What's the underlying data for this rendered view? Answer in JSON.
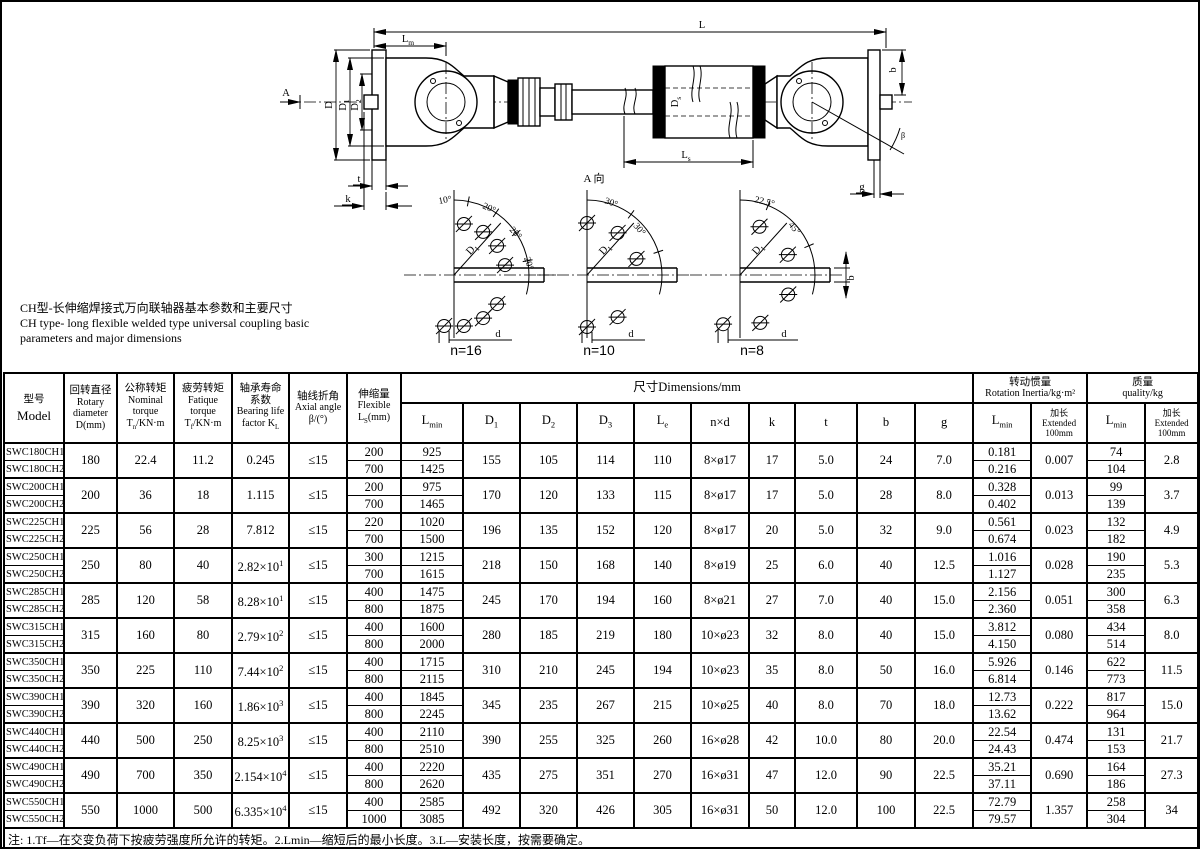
{
  "title_block": {
    "zh": "CH型-长伸缩焊接式万向联轴器基本参数和主要尺寸",
    "en1": "CH type- long flexible welded type universal coupling basic",
    "en2": "parameters and major dimensions"
  },
  "drawing": {
    "lbl": {
      "L": "L",
      "Lm_b": "L",
      "Lm_s": "m",
      "Ls_b": "L",
      "Ls_s": "s",
      "D": "D",
      "D1_b": "D",
      "D1_s": "1",
      "D2_b": "D",
      "D2_s": "2",
      "Ds_b": "D",
      "Ds_s": "s",
      "A": "A",
      "view_label": "A 向",
      "t": "t",
      "k": "k",
      "g": "g",
      "b": "b",
      "beta": "β"
    },
    "diagrams": [
      {
        "label": "n=16",
        "angles": [
          "10°",
          "20°",
          "20°",
          "20°"
        ],
        "radial_base": "D",
        "radial_sub": "1",
        "hole": "d"
      },
      {
        "label": "n=10",
        "angles": [
          "30°",
          "30°"
        ],
        "radial_base": "D",
        "radial_sub": "1",
        "hole": "d"
      },
      {
        "label": "n=8",
        "angles": [
          "22.5°",
          "45°"
        ],
        "radial_base": "D",
        "radial_sub": "1",
        "hole": "d",
        "width_label": "b"
      }
    ]
  },
  "table": {
    "h": {
      "model_zh": "型号",
      "model_en": "Model",
      "rotary": [
        "回转直径",
        "Rotary",
        "diameter",
        "D(mm)"
      ],
      "nominal": [
        "公称转矩",
        "Nominal",
        "torque"
      ],
      "tn": [
        "T",
        "n",
        "/KN·m"
      ],
      "fatigue": [
        "疲劳转矩",
        "Fatique",
        "torque"
      ],
      "tf": [
        "T",
        "f",
        "/KN·m"
      ],
      "bearing": [
        "轴承寿命",
        "系数",
        "Bearing life"
      ],
      "kl": [
        "factor  K",
        "L"
      ],
      "axial": [
        "轴线折角",
        "Axial angle",
        "β/(°)"
      ],
      "flex": [
        "伸缩量",
        "Flexible"
      ],
      "ls": [
        "L",
        "S",
        "(mm)"
      ],
      "dims": "尺寸Dimensions/mm",
      "lmin": [
        "L",
        "min"
      ],
      "d1": [
        "D",
        "1"
      ],
      "d2": [
        "D",
        "2"
      ],
      "d3": [
        "D",
        "3"
      ],
      "le": [
        "L",
        "e"
      ],
      "nxd": "n×d",
      "k": "k",
      "t": "t",
      "b": "b",
      "g": "g",
      "inertia_zh": "转动惯量",
      "inertia_en": "Rotation Inertia/kg·m²",
      "mass_zh": "质量",
      "mass_en": "quality/kg",
      "ext": [
        "加长",
        "Extended",
        "100mm"
      ]
    },
    "rows": [
      {
        "m": [
          "SWC180CH1",
          "SWC180CH2"
        ],
        "d": "180",
        "tn": "22.4",
        "tf": "11.2",
        "kl": "0.245",
        "beta": "≤15",
        "ls": [
          "200",
          "700"
        ],
        "lmin": [
          "925",
          "1425"
        ],
        "d1": "155",
        "d2": "105",
        "d3": "114",
        "le": "110",
        "nxd": "8×ø17",
        "k": "17",
        "t": "5.0",
        "b": "24",
        "g": "7.0",
        "ji": [
          "0.181",
          "0.216"
        ],
        "je": "0.007",
        "mi": [
          "74",
          "104"
        ],
        "me": "2.8"
      },
      {
        "m": [
          "SWC200CH1",
          "SWC200CH2"
        ],
        "d": "200",
        "tn": "36",
        "tf": "18",
        "kl": "1.115",
        "beta": "≤15",
        "ls": [
          "200",
          "700"
        ],
        "lmin": [
          "975",
          "1465"
        ],
        "d1": "170",
        "d2": "120",
        "d3": "133",
        "le": "115",
        "nxd": "8×ø17",
        "k": "17",
        "t": "5.0",
        "b": "28",
        "g": "8.0",
        "ji": [
          "0.328",
          "0.402"
        ],
        "je": "0.013",
        "mi": [
          "99",
          "139"
        ],
        "me": "3.7"
      },
      {
        "m": [
          "SWC225CH1",
          "SWC225CH2"
        ],
        "d": "225",
        "tn": "56",
        "tf": "28",
        "kl": "7.812",
        "beta": "≤15",
        "ls": [
          "220",
          "700"
        ],
        "lmin": [
          "1020",
          "1500"
        ],
        "d1": "196",
        "d2": "135",
        "d3": "152",
        "le": "120",
        "nxd": "8×ø17",
        "k": "20",
        "t": "5.0",
        "b": "32",
        "g": "9.0",
        "ji": [
          "0.561",
          "0.674"
        ],
        "je": "0.023",
        "mi": [
          "132",
          "182"
        ],
        "me": "4.9"
      },
      {
        "m": [
          "SWC250CH1",
          "SWC250CH2"
        ],
        "d": "250",
        "tn": "80",
        "tf": "40",
        "kl": "2.82×10^1",
        "beta": "≤15",
        "ls": [
          "300",
          "700"
        ],
        "lmin": [
          "1215",
          "1615"
        ],
        "d1": "218",
        "d2": "150",
        "d3": "168",
        "le": "140",
        "nxd": "8×ø19",
        "k": "25",
        "t": "6.0",
        "b": "40",
        "g": "12.5",
        "ji": [
          "1.016",
          "1.127"
        ],
        "je": "0.028",
        "mi": [
          "190",
          "235"
        ],
        "me": "5.3"
      },
      {
        "m": [
          "SWC285CH1",
          "SWC285CH2"
        ],
        "d": "285",
        "tn": "120",
        "tf": "58",
        "kl": "8.28×10^1",
        "beta": "≤15",
        "ls": [
          "400",
          "800"
        ],
        "lmin": [
          "1475",
          "1875"
        ],
        "d1": "245",
        "d2": "170",
        "d3": "194",
        "le": "160",
        "nxd": "8×ø21",
        "k": "27",
        "t": "7.0",
        "b": "40",
        "g": "15.0",
        "ji": [
          "2.156",
          "2.360"
        ],
        "je": "0.051",
        "mi": [
          "300",
          "358"
        ],
        "me": "6.3"
      },
      {
        "m": [
          "SWC315CH1",
          "SWC315CH2"
        ],
        "d": "315",
        "tn": "160",
        "tf": "80",
        "kl": "2.79×10^2",
        "beta": "≤15",
        "ls": [
          "400",
          "800"
        ],
        "lmin": [
          "1600",
          "2000"
        ],
        "d1": "280",
        "d2": "185",
        "d3": "219",
        "le": "180",
        "nxd": "10×ø23",
        "k": "32",
        "t": "8.0",
        "b": "40",
        "g": "15.0",
        "ji": [
          "3.812",
          "4.150"
        ],
        "je": "0.080",
        "mi": [
          "434",
          "514"
        ],
        "me": "8.0"
      },
      {
        "m": [
          "SWC350CH1",
          "SWC350CH2"
        ],
        "d": "350",
        "tn": "225",
        "tf": "110",
        "kl": "7.44×10^2",
        "beta": "≤15",
        "ls": [
          "400",
          "800"
        ],
        "lmin": [
          "1715",
          "2115"
        ],
        "d1": "310",
        "d2": "210",
        "d3": "245",
        "le": "194",
        "nxd": "10×ø23",
        "k": "35",
        "t": "8.0",
        "b": "50",
        "g": "16.0",
        "ji": [
          "5.926",
          "6.814"
        ],
        "je": "0.146",
        "mi": [
          "622",
          "773"
        ],
        "me": "11.5"
      },
      {
        "m": [
          "SWC390CH1",
          "SWC390CH2"
        ],
        "d": "390",
        "tn": "320",
        "tf": "160",
        "kl": "1.86×10^3",
        "beta": "≤15",
        "ls": [
          "400",
          "800"
        ],
        "lmin": [
          "1845",
          "2245"
        ],
        "d1": "345",
        "d2": "235",
        "d3": "267",
        "le": "215",
        "nxd": "10×ø25",
        "k": "40",
        "t": "8.0",
        "b": "70",
        "g": "18.0",
        "ji": [
          "12.73",
          "13.62"
        ],
        "je": "0.222",
        "mi": [
          "817",
          "964"
        ],
        "me": "15.0"
      },
      {
        "m": [
          "SWC440CH1",
          "SWC440CH2"
        ],
        "d": "440",
        "tn": "500",
        "tf": "250",
        "kl": "8.25×10^3",
        "beta": "≤15",
        "ls": [
          "400",
          "800"
        ],
        "lmin": [
          "2110",
          "2510"
        ],
        "d1": "390",
        "d2": "255",
        "d3": "325",
        "le": "260",
        "nxd": "16×ø28",
        "k": "42",
        "t": "10.0",
        "b": "80",
        "g": "20.0",
        "ji": [
          "22.54",
          "24.43"
        ],
        "je": "0.474",
        "mi": [
          "131",
          "153"
        ],
        "me": "21.7"
      },
      {
        "m": [
          "SWC490CH1",
          "SWC490CH2"
        ],
        "d": "490",
        "tn": "700",
        "tf": "350",
        "kl": "2.154×10^4",
        "beta": "≤15",
        "ls": [
          "400",
          "800"
        ],
        "lmin": [
          "2220",
          "2620"
        ],
        "d1": "435",
        "d2": "275",
        "d3": "351",
        "le": "270",
        "nxd": "16×ø31",
        "k": "47",
        "t": "12.0",
        "b": "90",
        "g": "22.5",
        "ji": [
          "35.21",
          "37.11"
        ],
        "je": "0.690",
        "mi": [
          "164",
          "186"
        ],
        "me": "27.3"
      },
      {
        "m": [
          "SWC550CH1",
          "SWC550CH2"
        ],
        "d": "550",
        "tn": "1000",
        "tf": "500",
        "kl": "6.335×10^4",
        "beta": "≤15",
        "ls": [
          "400",
          "1000"
        ],
        "lmin": [
          "2585",
          "3085"
        ],
        "d1": "492",
        "d2": "320",
        "d3": "426",
        "le": "305",
        "nxd": "16×ø31",
        "k": "50",
        "t": "12.0",
        "b": "100",
        "g": "22.5",
        "ji": [
          "72.79",
          "79.57"
        ],
        "je": "1.357",
        "mi": [
          "258",
          "304"
        ],
        "me": "34"
      }
    ]
  },
  "notes": {
    "zh": "注: 1.Tf—在交变负荷下按疲劳强度所允许的转矩。2.Lmin—缩短后的最小长度。3.L—安装长度，按需要确定。",
    "en": "remark: 1.Tf—Permissible torque as per the to fatigue strength under alternate load.2.Lmin—Minimum length after reducing.3.L—Mounting dimension determined by the requirement."
  }
}
